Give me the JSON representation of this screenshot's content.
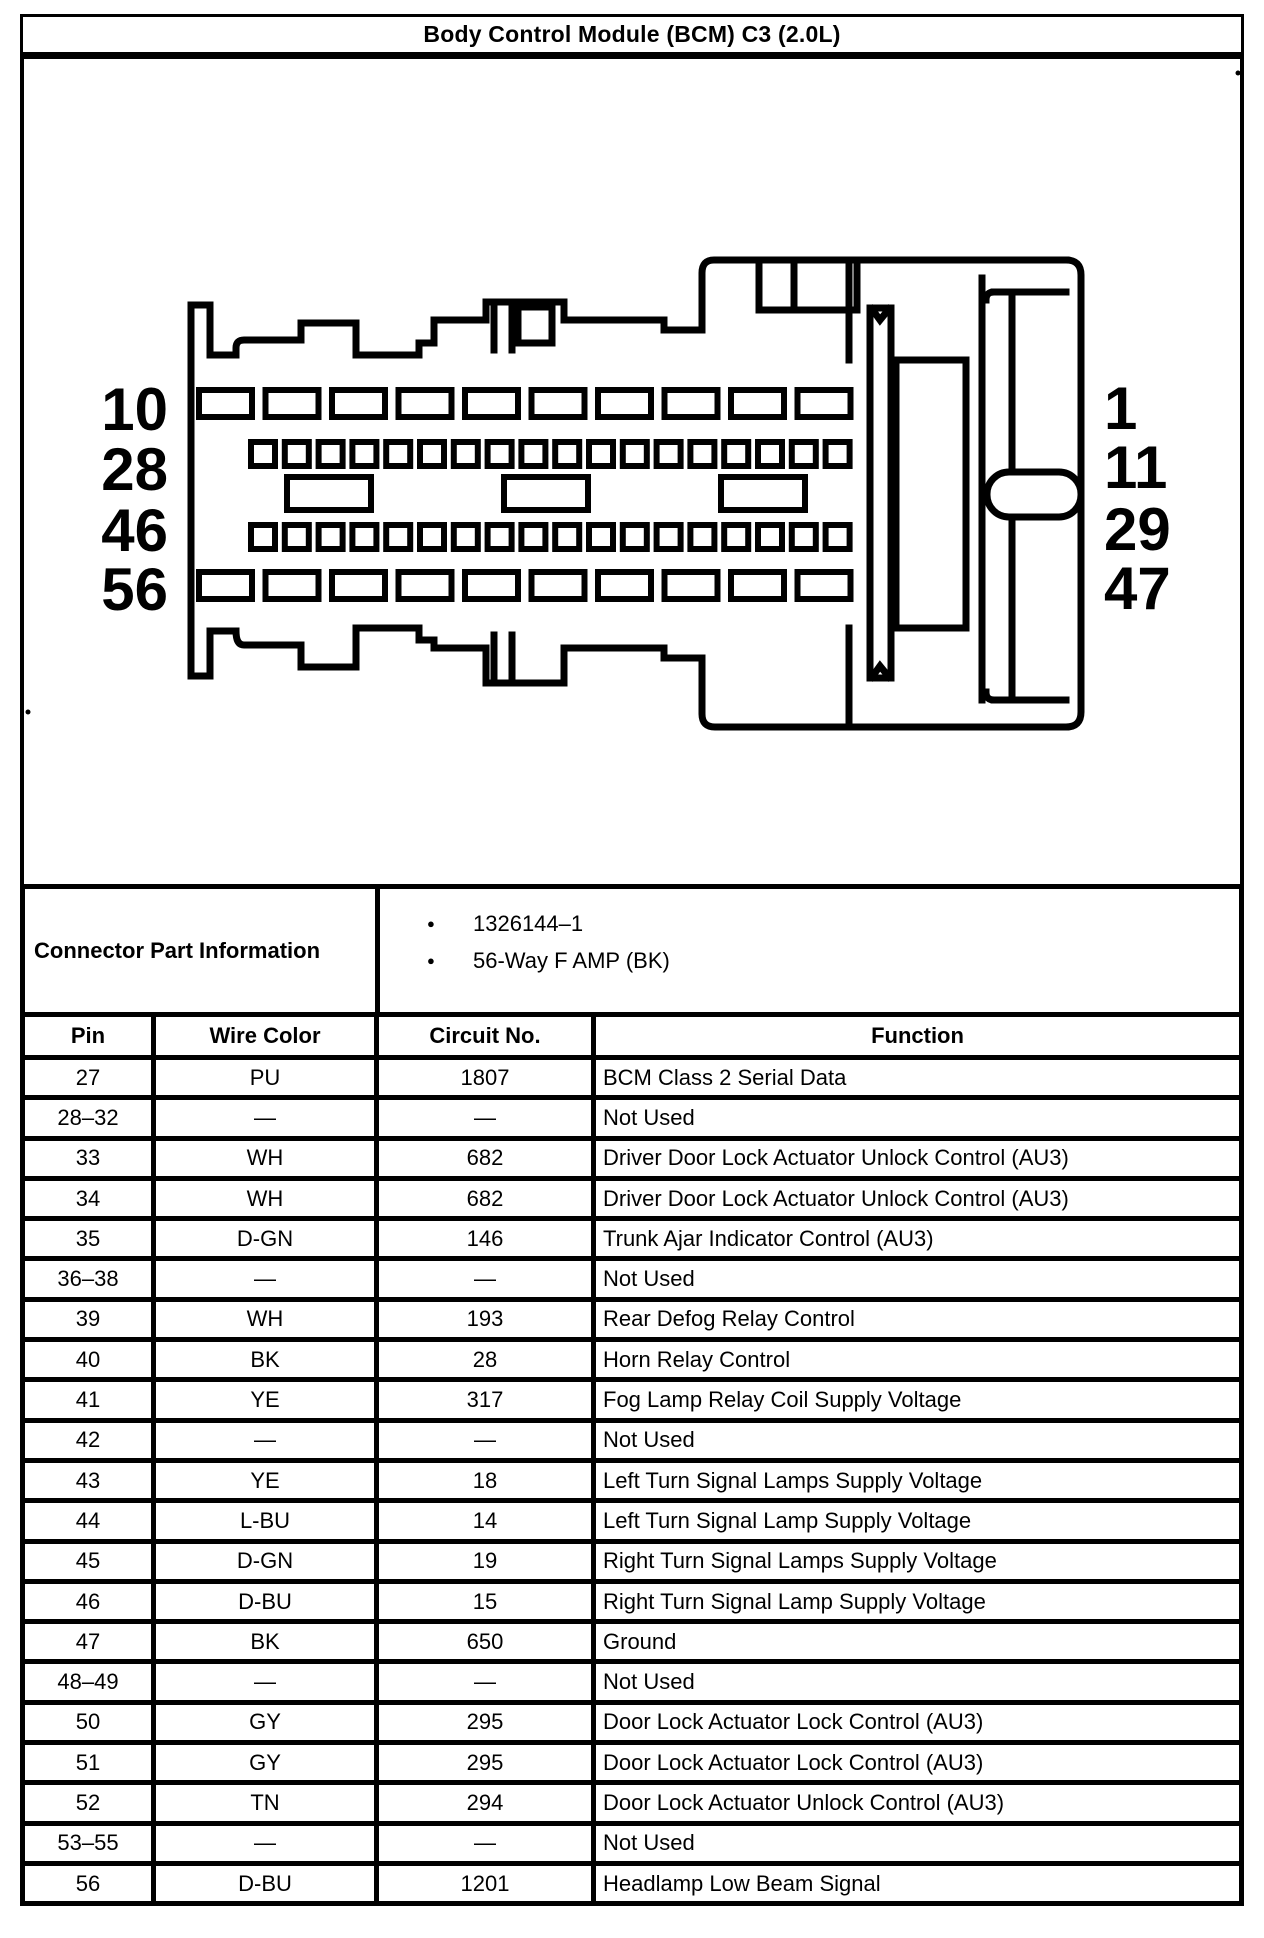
{
  "title": "Body Control Module (BCM) C3 (2.0L)",
  "connector": {
    "left_labels": [
      "10",
      "28",
      "46",
      "56"
    ],
    "right_labels": [
      "1",
      "11",
      "29",
      "47"
    ]
  },
  "part_info": {
    "label": "Connector Part Information",
    "items": [
      "1326144–1",
      "56-Way F AMP (BK)"
    ]
  },
  "table": {
    "headers": [
      "Pin",
      "Wire Color",
      "Circuit No.",
      "Function"
    ],
    "rows": [
      [
        "27",
        "PU",
        "1807",
        "BCM Class 2 Serial Data"
      ],
      [
        "28–32",
        "—",
        "—",
        "Not Used"
      ],
      [
        "33",
        "WH",
        "682",
        "Driver Door Lock Actuator Unlock Control (AU3)"
      ],
      [
        "34",
        "WH",
        "682",
        "Driver Door Lock Actuator Unlock Control (AU3)"
      ],
      [
        "35",
        "D-GN",
        "146",
        "Trunk Ajar Indicator Control (AU3)"
      ],
      [
        "36–38",
        "—",
        "—",
        "Not Used"
      ],
      [
        "39",
        "WH",
        "193",
        "Rear Defog Relay Control"
      ],
      [
        "40",
        "BK",
        "28",
        "Horn Relay Control"
      ],
      [
        "41",
        "YE",
        "317",
        "Fog Lamp Relay Coil Supply Voltage"
      ],
      [
        "42",
        "—",
        "—",
        "Not Used"
      ],
      [
        "43",
        "YE",
        "18",
        "Left Turn Signal Lamps Supply Voltage"
      ],
      [
        "44",
        "L-BU",
        "14",
        "Left Turn Signal Lamp Supply Voltage"
      ],
      [
        "45",
        "D-GN",
        "19",
        "Right Turn Signal Lamps Supply Voltage"
      ],
      [
        "46",
        "D-BU",
        "15",
        "Right Turn Signal Lamp Supply Voltage"
      ],
      [
        "47",
        "BK",
        "650",
        "Ground"
      ],
      [
        "48–49",
        "—",
        "—",
        "Not Used"
      ],
      [
        "50",
        "GY",
        "295",
        "Door Lock Actuator Lock Control (AU3)"
      ],
      [
        "51",
        "GY",
        "295",
        "Door Lock Actuator Lock Control (AU3)"
      ],
      [
        "52",
        "TN",
        "294",
        "Door Lock Actuator Unlock Control (AU3)"
      ],
      [
        "53–55",
        "—",
        "—",
        "Not Used"
      ],
      [
        "56",
        "D-BU",
        "1201",
        "Headlamp Low Beam Signal"
      ]
    ]
  }
}
